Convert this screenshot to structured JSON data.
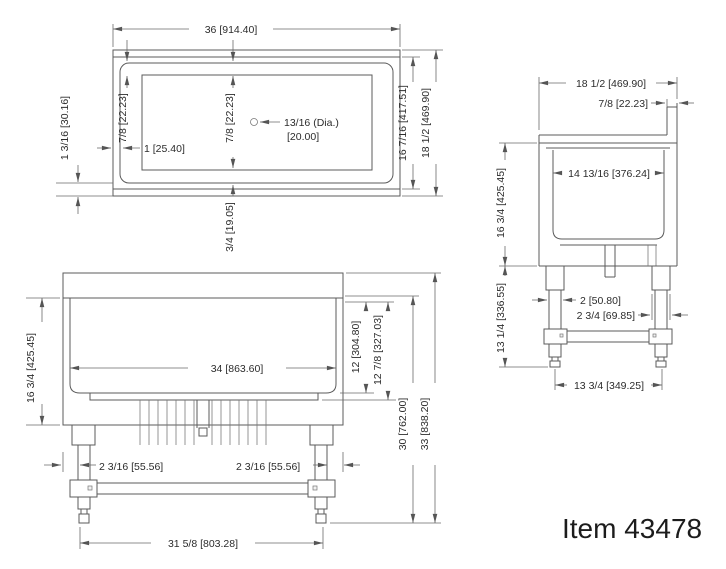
{
  "item_label": "Item 43478",
  "views": {
    "plan": {
      "dims": {
        "overall_width": "36 [914.40]",
        "rim_left": "7/8 [22.23]",
        "rim_center": "7/8 [22.23]",
        "hole_dia": "13/16 (Dia.)",
        "hole_dia_mm": "[20.00]",
        "rim_side": "1 [25.40]",
        "edge_front": "1 3/16 [30.16]",
        "rim_bottom": "3/4 [19.05]",
        "inner_depth": "16 7/16 [417.51]",
        "overall_depth": "18 1/2 [469.90]"
      }
    },
    "front": {
      "dims": {
        "inner_width": "34 [863.60]",
        "body_height": "16 3/4 [425.45]",
        "basin_drop": "12 [304.80]",
        "basin_drop_outer": "12 7/8 [327.03]",
        "counter_height": "30 [762.00]",
        "overall_height": "33 [838.20]",
        "leg_inset_left": "2 3/16 [55.56]",
        "leg_inset_right": "2 3/16 [55.56]",
        "leg_span": "31 5/8 [803.28]"
      }
    },
    "side": {
      "dims": {
        "overall_depth": "18 1/2 [469.90]",
        "splash_thickness": "7/8 [22.23]",
        "inner_depth": "14 13/16 [376.24]",
        "body_height": "16 3/4 [425.45]",
        "leg_height": "13 1/4 [336.55]",
        "leg_width": "2 [50.80]",
        "gusset_width": "2 3/4 [69.85]",
        "foot_span": "13 3/4 [349.25]"
      }
    }
  }
}
